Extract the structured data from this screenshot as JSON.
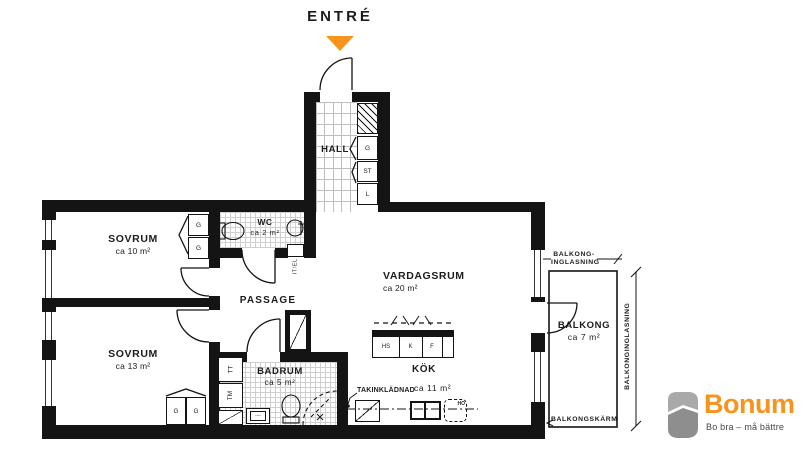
{
  "entry": {
    "label": "ENTRÉ"
  },
  "rooms": {
    "hall": {
      "name": "HALL"
    },
    "wc": {
      "name": "WC",
      "area": "ca 2 m²"
    },
    "sovrum_10": {
      "name": "SOVRUM",
      "area": "ca 10 m²"
    },
    "sovrum_13": {
      "name": "SOVRUM",
      "area": "ca 13 m²"
    },
    "passage": {
      "name": "PASSAGE"
    },
    "vardagsrum": {
      "name": "VARDAGSRUM",
      "area": "ca 20 m²"
    },
    "badrum": {
      "name": "BADRUM",
      "area": "ca 5 m²"
    },
    "kok": {
      "name": "KÖK",
      "area": "ca 11 m²"
    },
    "balkong": {
      "name": "BALKONG",
      "area": "ca 7 m²"
    }
  },
  "fixtures": {
    "g": "G",
    "st": "ST",
    "l": "L",
    "tt": "TT",
    "tm": "TM",
    "hs": "HS",
    "k": "K",
    "f": "F",
    "ho": "HO",
    "it_el": "IT/EL"
  },
  "annotations": {
    "takinkladnad": "TAKINKLÄDNAD",
    "balkong_inglasning_line1": "BALKONG-",
    "balkong_inglasning_line2": "INGLASNING",
    "balkong_inglasning_vertical": "BALKONGINGLASNING",
    "balkongskarm": "BALKONGSKÄRM"
  },
  "logo": {
    "brand": "Bonum",
    "tagline": "Bo bra – må bättre"
  },
  "colors": {
    "accent": "#F7941D",
    "wall": "#141414",
    "logo_gray": "#9B9B9B",
    "tagline_gray": "#45454F"
  }
}
